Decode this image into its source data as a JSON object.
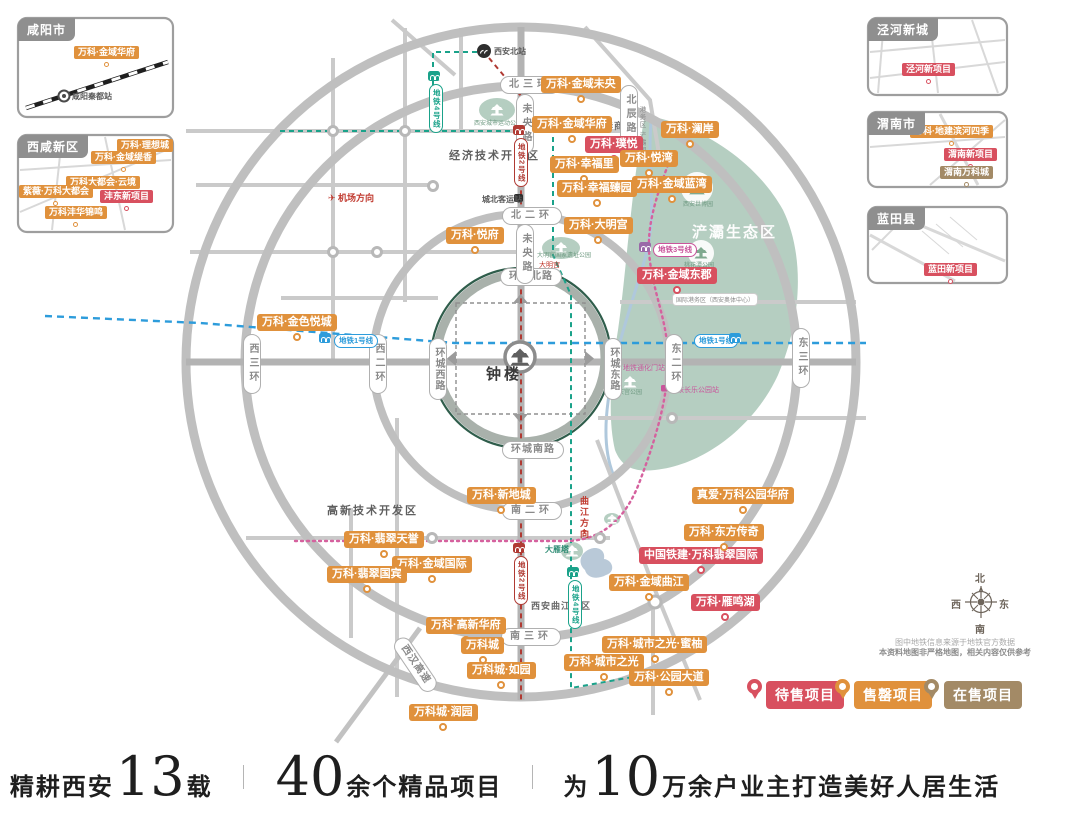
{
  "palette": {
    "o": "#E0913C",
    "r": "#D8505F",
    "b": "#A38A66",
    "l1": "#2D9CDB",
    "l2": "#B03A33",
    "l3": "#C9549B",
    "l4": "#1AA28A"
  },
  "projects": [
    {
      "t": "万科·金域未央",
      "x": 541,
      "y": 76,
      "c": "o"
    },
    {
      "t": "万科·金域华府",
      "x": 532,
      "y": 116,
      "c": "o"
    },
    {
      "t": "万科·璞悦",
      "x": 585,
      "y": 136,
      "c": "r"
    },
    {
      "t": "万科·悦湾",
      "x": 620,
      "y": 150,
      "c": "o"
    },
    {
      "t": "万科·幸福里",
      "x": 550,
      "y": 156,
      "c": "o"
    },
    {
      "t": "万科·幸福臻园",
      "x": 557,
      "y": 180,
      "c": "o"
    },
    {
      "t": "万科·金域蓝湾",
      "x": 632,
      "y": 176,
      "c": "o"
    },
    {
      "t": "万科·澜岸",
      "x": 661,
      "y": 121,
      "c": "o"
    },
    {
      "t": "万科·大明宫",
      "x": 564,
      "y": 217,
      "c": "o"
    },
    {
      "t": "万科·悦府",
      "x": 446,
      "y": 227,
      "c": "o"
    },
    {
      "t": "万科·金色悦城",
      "x": 257,
      "y": 314,
      "c": "o"
    },
    {
      "t": "万科·金域东郡",
      "x": 637,
      "y": 267,
      "c": "r"
    },
    {
      "t": "万科·新地城",
      "x": 467,
      "y": 487,
      "c": "o"
    },
    {
      "t": "万科·翡翠天誉",
      "x": 344,
      "y": 531,
      "c": "o"
    },
    {
      "t": "万科·金域国际",
      "x": 392,
      "y": 556,
      "c": "o"
    },
    {
      "t": "万科·翡翠国宾",
      "x": 327,
      "y": 566,
      "c": "o"
    },
    {
      "t": "万科·高新华府",
      "x": 426,
      "y": 617,
      "c": "o"
    },
    {
      "t": "万科城",
      "x": 461,
      "y": 637,
      "c": "o"
    },
    {
      "t": "万科城·如园",
      "x": 467,
      "y": 662,
      "c": "o"
    },
    {
      "t": "万科城·润园",
      "x": 409,
      "y": 704,
      "c": "o"
    },
    {
      "t": "万科·城市之光",
      "x": 564,
      "y": 654,
      "c": "o"
    },
    {
      "t": "万科·城市之光·蜜柚",
      "x": 602,
      "y": 636,
      "c": "o"
    },
    {
      "t": "万科·公园大道",
      "x": 629,
      "y": 669,
      "c": "o"
    },
    {
      "t": "万科·雁鸣湖",
      "x": 691,
      "y": 594,
      "c": "r"
    },
    {
      "t": "万科·金域曲江",
      "x": 609,
      "y": 574,
      "c": "o"
    },
    {
      "t": "中国铁建·万科翡翠国际",
      "x": 639,
      "y": 547,
      "c": "r"
    },
    {
      "t": "万科·东方传奇",
      "x": 684,
      "y": 524,
      "c": "o"
    },
    {
      "t": "真爱·万科公园华府",
      "x": 692,
      "y": 487,
      "c": "o"
    },
    {
      "t": "万科·金域华府",
      "x": 74,
      "y": 46,
      "c": "o",
      "s": 1
    },
    {
      "t": "万科·理想城",
      "x": 117,
      "y": 139,
      "c": "o",
      "s": 1
    },
    {
      "t": "万科·金域缇香",
      "x": 91,
      "y": 151,
      "c": "o",
      "s": 1
    },
    {
      "t": "万科大都会·云境",
      "x": 66,
      "y": 176,
      "c": "o",
      "s": 1
    },
    {
      "t": "紫薇·万科大都会",
      "x": 19,
      "y": 185,
      "c": "o",
      "s": 1
    },
    {
      "t": "沣东新项目",
      "x": 100,
      "y": 190,
      "c": "r",
      "s": 1
    },
    {
      "t": "万科沣华锦鸣",
      "x": 45,
      "y": 206,
      "c": "o",
      "s": 1
    },
    {
      "t": "泾河新项目",
      "x": 902,
      "y": 63,
      "c": "r",
      "s": 1
    },
    {
      "t": "万科·地建滨河四季",
      "x": 910,
      "y": 125,
      "c": "o",
      "s": 1
    },
    {
      "t": "渭南新项目",
      "x": 944,
      "y": 148,
      "c": "r",
      "s": 1
    },
    {
      "t": "渭南万科城",
      "x": 940,
      "y": 166,
      "c": "b",
      "s": 1
    },
    {
      "t": "蓝田新项目",
      "x": 924,
      "y": 263,
      "c": "r",
      "s": 1
    }
  ],
  "road_pills": [
    {
      "t": "北三环",
      "x": 500,
      "y": 76,
      "o": "h"
    },
    {
      "t": "北二环",
      "x": 502,
      "y": 207,
      "o": "h"
    },
    {
      "t": "环城北路",
      "x": 500,
      "y": 268,
      "o": "h"
    },
    {
      "t": "环城南路",
      "x": 502,
      "y": 441,
      "o": "h"
    },
    {
      "t": "南二环",
      "x": 502,
      "y": 502,
      "o": "h"
    },
    {
      "t": "南三环",
      "x": 501,
      "y": 628,
      "o": "h"
    },
    {
      "t": "西三环",
      "x": 243,
      "y": 334,
      "o": "v"
    },
    {
      "t": "西二环",
      "x": 369,
      "y": 334,
      "o": "v"
    },
    {
      "t": "环城西路",
      "x": 429,
      "y": 338,
      "o": "v"
    },
    {
      "t": "环城东路",
      "x": 604,
      "y": 338,
      "o": "v"
    },
    {
      "t": "东二环",
      "x": 665,
      "y": 334,
      "o": "v"
    },
    {
      "t": "东三环",
      "x": 792,
      "y": 328,
      "o": "v"
    },
    {
      "t": "未央路",
      "x": 516,
      "y": 94,
      "o": "v"
    },
    {
      "t": "未央路",
      "x": 516,
      "y": 224,
      "o": "v"
    },
    {
      "t": "北辰路",
      "x": 620,
      "y": 85,
      "o": "v"
    },
    {
      "t": "西汉高速",
      "x": 398,
      "y": 630,
      "o": "h",
      "rot": 56
    }
  ],
  "metro_pills": [
    {
      "t": "地铁4号线",
      "x": 429,
      "y": 84,
      "o": "v",
      "c": "l4",
      "icon": [
        428,
        71
      ]
    },
    {
      "t": "地铁2号线",
      "x": 514,
      "y": 138,
      "o": "v",
      "c": "l2",
      "icon": [
        513,
        125
      ]
    },
    {
      "t": "地铁2号线",
      "x": 514,
      "y": 556,
      "o": "v",
      "c": "l2",
      "icon": [
        513,
        543
      ]
    },
    {
      "t": "地铁4号线",
      "x": 568,
      "y": 580,
      "o": "v",
      "c": "l4",
      "icon": [
        567,
        567
      ]
    },
    {
      "t": "地铁1号线",
      "x": 334,
      "y": 334,
      "o": "h",
      "c": "l1",
      "icon": [
        319,
        333
      ]
    },
    {
      "t": "地铁1号线",
      "x": 694,
      "y": 334,
      "o": "h",
      "c": "l1",
      "icon": [
        729,
        333
      ]
    },
    {
      "t": "地铁3号线",
      "x": 653,
      "y": 243,
      "o": "h",
      "c": "l3",
      "icon": [
        639,
        242
      ],
      "ic": "#9A69A8"
    }
  ],
  "texts": [
    {
      "k": "district",
      "t": "经济技术开发区",
      "x": 449,
      "y": 147
    },
    {
      "k": "district",
      "t": "高新技术开发区",
      "x": 327,
      "y": 502
    },
    {
      "k": "district2",
      "t": "西安曲江新区",
      "x": 531,
      "y": 599
    },
    {
      "k": "district2",
      "t": "太华商圈",
      "x": 594,
      "y": 119
    },
    {
      "k": "zhonglou",
      "t": "钟楼",
      "x": 486,
      "y": 363
    },
    {
      "k": "areawhite",
      "t": "浐灞生态区",
      "x": 692,
      "y": 221
    },
    {
      "k": "park",
      "t": "西安城市运动公园",
      "x": 474,
      "y": 118
    },
    {
      "k": "park",
      "t": "大明宫国家遗址公园",
      "x": 537,
      "y": 250
    },
    {
      "k": "park",
      "t": "兴庆宫公园",
      "x": 612,
      "y": 387
    },
    {
      "k": "park",
      "t": "桃花潭公园",
      "x": 684,
      "y": 260
    },
    {
      "k": "park",
      "t": "西安世博园",
      "x": 683,
      "y": 199
    },
    {
      "k": "teal",
      "t": "大雁塔",
      "x": 545,
      "y": 544
    },
    {
      "k": "redh",
      "t": "✈ 机场方向",
      "x": 328,
      "y": 191
    },
    {
      "k": "redtiny",
      "t": "大明宫",
      "x": 539,
      "y": 260
    },
    {
      "k": "redv",
      "t": "曲江方向",
      "x": 578,
      "y": 496
    },
    {
      "k": "redtiny",
      "t": "▼",
      "x": 581,
      "y": 529
    },
    {
      "k": "vgrey",
      "t": "港务区 浐灞国际",
      "x": 636,
      "y": 106
    },
    {
      "k": "micropill",
      "t": "国际港务区（西安奥体中心）",
      "x": 672,
      "y": 293
    },
    {
      "k": "sta",
      "t": "西安北站",
      "x": 494,
      "y": 46
    },
    {
      "k": "sta",
      "t": "城北客运站",
      "x": 482,
      "y": 194
    },
    {
      "k": "msta",
      "t": "地铁通化门站",
      "x": 623,
      "y": 363
    },
    {
      "k": "msta",
      "t": "地铁长乐公园站",
      "x": 670,
      "y": 385
    },
    {
      "k": "sta",
      "t": "咸阳秦都站",
      "x": 72,
      "y": 91
    }
  ],
  "insets": [
    {
      "title": "咸阳市",
      "x": 18,
      "y": 18
    },
    {
      "title": "西咸新区",
      "x": 18,
      "y": 135
    },
    {
      "title": "泾河新城",
      "x": 868,
      "y": 18
    },
    {
      "title": "渭南市",
      "x": 868,
      "y": 112
    },
    {
      "title": "蓝田县",
      "x": 868,
      "y": 207
    }
  ],
  "legend": {
    "y": 679,
    "items": [
      {
        "t": "待售项目",
        "c": "r",
        "pin_x": 747,
        "label_x": 766
      },
      {
        "t": "售罄项目",
        "c": "o",
        "pin_x": 835,
        "label_x": 854
      },
      {
        "t": "在售项目",
        "c": "b",
        "pin_x": 924,
        "label_x": 944
      }
    ]
  },
  "compass": {
    "n": "北",
    "e": "东",
    "s": "南",
    "w": "西"
  },
  "disclaimer": {
    "line1": "图中地铁信息来源于地铁官方数据",
    "line2": "本资料地图非严格地图，相关内容仅供参考"
  },
  "footer": {
    "segments": [
      {
        "pre": "精耕西安",
        "num": "13",
        "suf": "载"
      },
      {
        "pre": "",
        "num": "40",
        "suf": "余个精品项目"
      },
      {
        "pre": "为",
        "num": "10",
        "suf": "万余户业主打造美好人居生活"
      }
    ]
  }
}
